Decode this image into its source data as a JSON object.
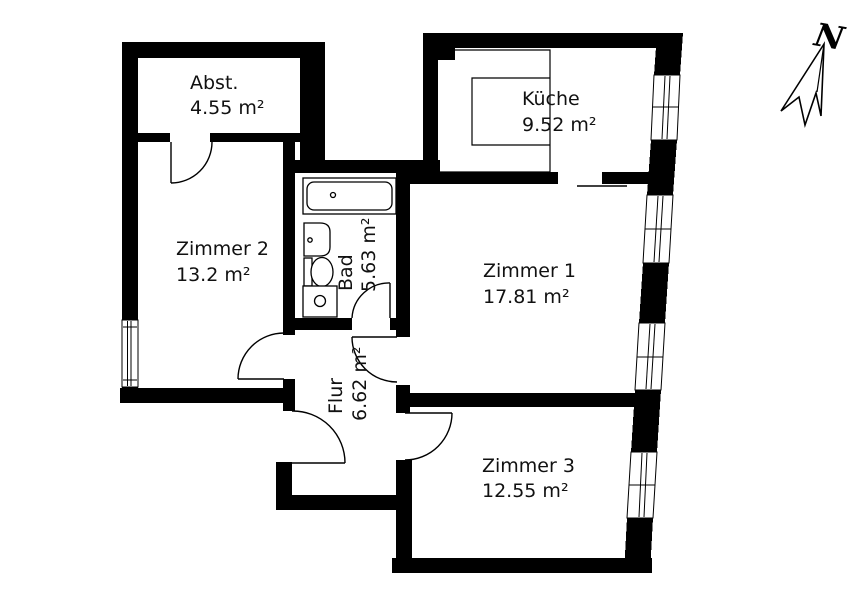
{
  "plan": {
    "type": "apartment-floor-plan",
    "wall_color": "#000000",
    "floor_color": "#ffffff",
    "north_indicator": {
      "label": "N"
    },
    "rooms": [
      {
        "id": "abst",
        "name": "Abst.",
        "area": "4.55 m²"
      },
      {
        "id": "kueche",
        "name": "Küche",
        "area": "9.52 m²"
      },
      {
        "id": "zimmer2",
        "name": "Zimmer 2",
        "area": "13.2 m²"
      },
      {
        "id": "bad",
        "name": "Bad",
        "area": "5.63 m²"
      },
      {
        "id": "zimmer1",
        "name": "Zimmer 1",
        "area": "17.81 m²"
      },
      {
        "id": "flur",
        "name": "Flur",
        "area": "6.62 m²"
      },
      {
        "id": "zimmer3",
        "name": "Zimmer 3",
        "area": "12.55 m²"
      }
    ]
  }
}
